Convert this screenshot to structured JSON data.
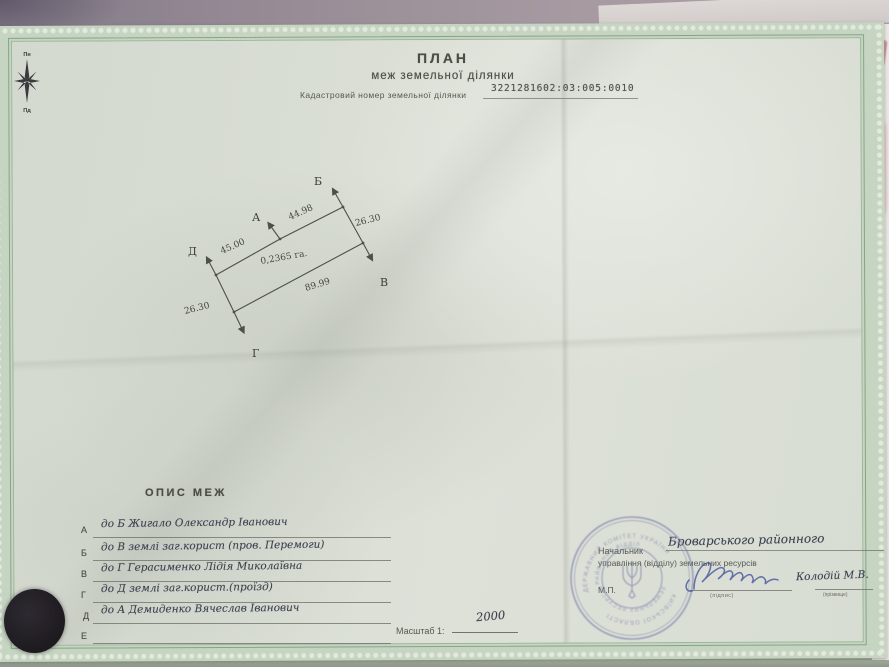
{
  "page": {
    "title": "ПЛАН",
    "subtitle": "меж земельної ділянки",
    "cadastral_label": "Кадастровий номер земельної ділянки",
    "cadastral_number": "3221281602:03:005:0010"
  },
  "compass": {
    "north": "Пн",
    "south": "Пд"
  },
  "diagram": {
    "area": "0,2365 га.",
    "label_a": "А",
    "label_b": "Б",
    "label_v": "В",
    "label_g": "Г",
    "label_d": "Д",
    "dim_top": "44.98",
    "dim_right": "26.30",
    "dim_left_top": "45.00",
    "dim_bottom": "89.99",
    "dim_left_bottom": "26.30"
  },
  "boundaries": {
    "heading": "ОПИС МЕЖ",
    "rows": [
      {
        "letter": "А",
        "text": "до Б Жигало Олександр Іванович"
      },
      {
        "letter": "Б",
        "text": "до В землі заг.корист (пров. Перемоги)"
      },
      {
        "letter": "В",
        "text": "до Г Герасименко Лідія Миколаївна"
      },
      {
        "letter": "Г",
        "text": "до Д землі заг.корист.(проїзд)"
      },
      {
        "letter": "Д",
        "text": "до А Демиденко Вячеслав Іванович"
      },
      {
        "letter": "Е",
        "text": ""
      }
    ]
  },
  "scale": {
    "label": "Масштаб 1:",
    "value": "2000"
  },
  "signature_block": {
    "office_handwritten": "Броварського районного",
    "role_line1": "Начальник",
    "role_line2": "управління (відділу) земельних ресурсів",
    "seal_mark": "М.П.",
    "signature_caption": "(підпис)",
    "name": "Колодій М.В.",
    "name_caption": "(прізвище)"
  },
  "stamp": {
    "ring_outer_top": "ДЕРЖАВНИЙ КОМІТЕТ УКРАЇНИ",
    "ring_outer_bottom": "КИЇВСЬКОЇ ОБЛАСТІ",
    "ring_inner_top": "РАЙОННИЙ ВІДДІЛ",
    "ring_inner_bottom": "ЗЕМЕЛЬНИХ РЕСУРСІВ"
  },
  "colors": {
    "certificate_green": "#c6d4c2",
    "border_green": "#87a585",
    "stamp_blue": "#6b70a3",
    "ink_blue": "#41519b",
    "print_gray": "#4a4c45"
  }
}
